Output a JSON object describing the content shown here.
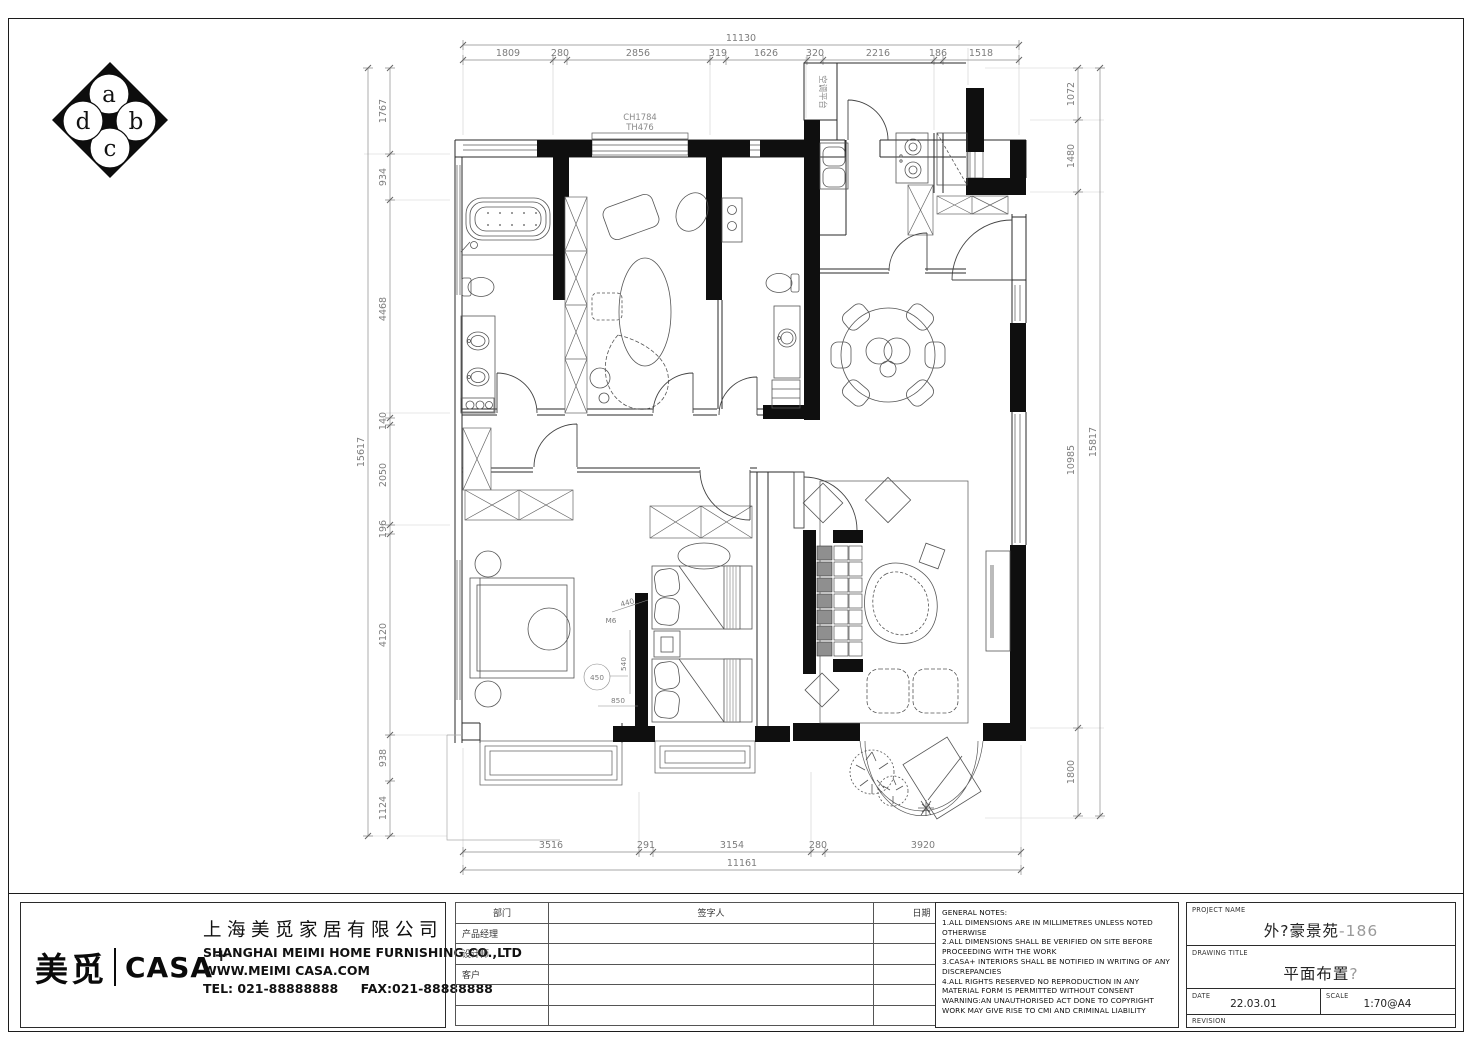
{
  "logo": {
    "a": "a",
    "b": "b",
    "c": "c",
    "d": "d"
  },
  "plan": {
    "window_head_label": "CH1784",
    "window_sill_label": "TH476",
    "ac_platform_label": "空调平台",
    "door_code_label": "M6",
    "inner_dims": {
      "d1": "440",
      "d2": "540",
      "d3": "850",
      "d4": "450"
    }
  },
  "dims": {
    "top": {
      "total": "11130",
      "segments": [
        "1809",
        "280",
        "2856",
        "319",
        "1626",
        "320",
        "2216",
        "186",
        "1518"
      ]
    },
    "bottom": {
      "total": "11161",
      "segments": [
        "3516",
        "291",
        "3154",
        "280",
        "3920"
      ]
    },
    "left": {
      "total": "15617",
      "segments": [
        "1767",
        "934",
        "4468",
        "140",
        "2050",
        "196",
        "4120",
        "938",
        "1124"
      ]
    },
    "right": {
      "total": "15817",
      "segments": [
        "1072",
        "1480",
        "10985",
        "1800"
      ]
    }
  },
  "company": {
    "brand_cn": "美觅",
    "brand_en": "CASA",
    "brand_plus": "+",
    "name_cn": "上海美觅家居有限公司",
    "name_en": "SHANGHAI MEIMI HOME FURNISHING CO.,LTD",
    "website": "WWW.MEIMI CASA.COM",
    "tel": "TEL: 021-88888888",
    "fax": "FAX:021-88888888"
  },
  "signature_table": {
    "col_department": "部门",
    "col_signer": "签字人",
    "col_date": "日期",
    "rows": [
      "产品经理",
      "设计师",
      "客户"
    ]
  },
  "notes": {
    "title": "GENERAL NOTES:",
    "items": [
      "1.ALL DIMENSIONS ARE IN MILLIMETRES UNLESS NOTED OTHERWISE",
      "2.ALL DIMENSIONS SHALL BE VERIFIED ON SITE BEFORE PROCEEDING WITH THE WORK",
      "3.CASA+ INTERIORS SHALL BE NOTIFIED IN WRITING OF ANY DISCREPANCIES",
      "4.ALL RIGHTS RESERVED NO REPRODUCTION IN ANY MATERIAL FORM IS PERMITTED WITHOUT CONSENT WARNING:AN UNAUTHORISED ACT DONE TO COPYRIGHT WORK MAY GIVE RISE TO CMI AND CRIMINAL LIABILITY"
    ]
  },
  "title_block": {
    "project_label": "PROJECT NAME",
    "project_value_main": "外?豪景苑",
    "project_value_suffix": "-186",
    "drawing_label": "DRAWING TITLE",
    "drawing_value_main": "平面布置",
    "drawing_value_suffix": "?",
    "date_label": "DATE",
    "date_value": "22.03.01",
    "scale_label": "SCALE",
    "scale_value": "1:70@A4",
    "revision_label": "REVISION"
  }
}
